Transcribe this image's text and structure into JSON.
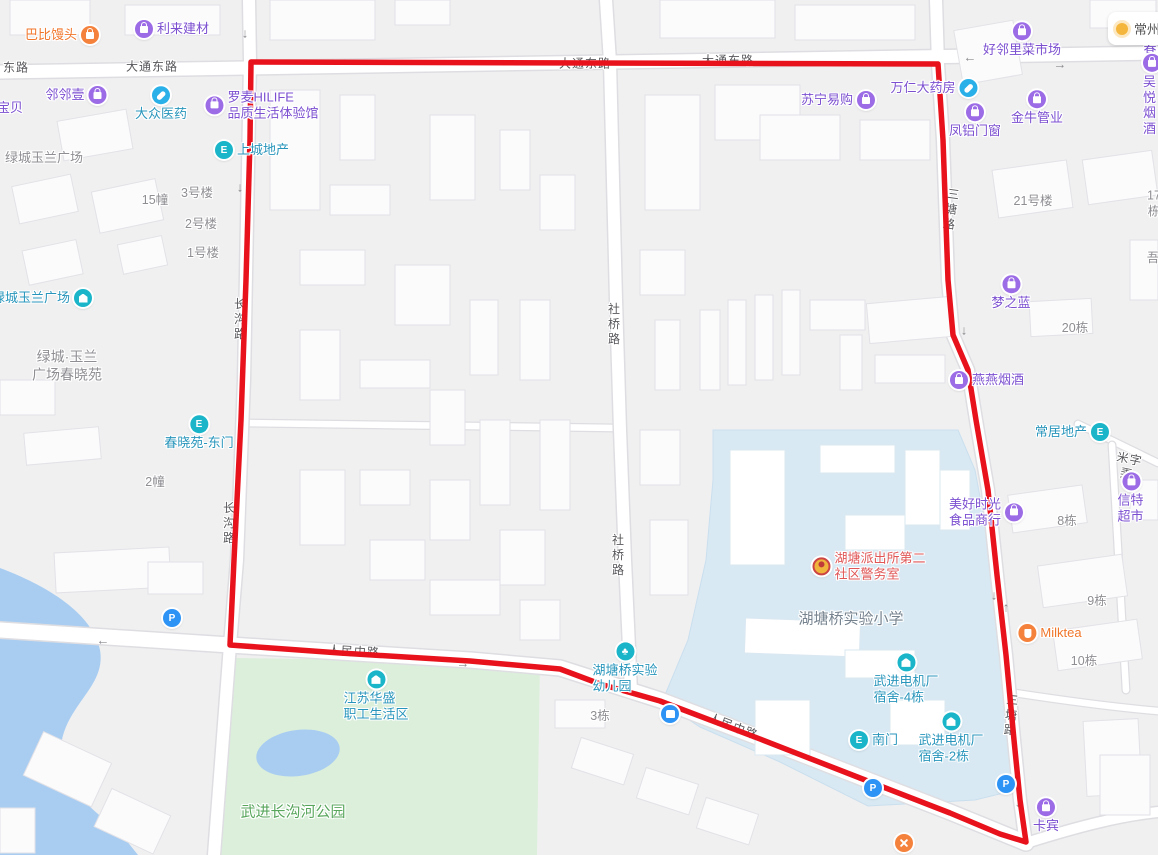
{
  "weather": {
    "city": "常州"
  },
  "route": {
    "color": "#e8121c",
    "points": [
      [
        251,
        62
      ],
      [
        938,
        64
      ],
      [
        943,
        140
      ],
      [
        948,
        280
      ],
      [
        953,
        335
      ],
      [
        968,
        370
      ],
      [
        976,
        420
      ],
      [
        988,
        490
      ],
      [
        997,
        575
      ],
      [
        1006,
        655
      ],
      [
        1014,
        740
      ],
      [
        1020,
        800
      ],
      [
        1026,
        842
      ],
      [
        1000,
        834
      ],
      [
        950,
        813
      ],
      [
        860,
        778
      ],
      [
        760,
        739
      ],
      [
        660,
        701
      ],
      [
        600,
        684
      ],
      [
        560,
        669
      ],
      [
        470,
        661
      ],
      [
        340,
        653
      ],
      [
        230,
        645
      ],
      [
        234,
        560
      ],
      [
        241,
        420
      ],
      [
        246,
        280
      ],
      [
        250,
        140
      ],
      [
        251,
        62
      ]
    ]
  },
  "road_labels": [
    {
      "name": "road-label-donglu",
      "text": "东路",
      "x": 16,
      "y": 68
    },
    {
      "name": "road-label-datongdonglu-1",
      "text": "大通东路",
      "x": 152,
      "y": 67
    },
    {
      "name": "road-label-datongdonglu-2",
      "text": "大通东路",
      "x": 585,
      "y": 64
    },
    {
      "name": "road-label-datongdonglu-3",
      "text": "大通东路",
      "x": 728,
      "y": 61
    },
    {
      "name": "road-label-changgoulu-1",
      "text": "长沟路",
      "x": 239,
      "y": 320,
      "vertical": true
    },
    {
      "name": "road-label-changgoulu-2",
      "text": "长沟路",
      "x": 228,
      "y": 524,
      "vertical": true
    },
    {
      "name": "road-label-sheqiaolu-1",
      "text": "社桥路",
      "x": 613,
      "y": 325,
      "vertical": true
    },
    {
      "name": "road-label-sheqiaolu-2",
      "text": "社桥路",
      "x": 617,
      "y": 556,
      "vertical": true
    },
    {
      "name": "road-label-santanglu-1",
      "text": "三塘路",
      "x": 950,
      "y": 210,
      "vertical": true,
      "rotate": 8
    },
    {
      "name": "road-label-santanglu-2",
      "text": "三塘路",
      "x": 1010,
      "y": 716,
      "vertical": true,
      "rotate": 5
    },
    {
      "name": "road-label-renminzhonglu-1",
      "text": "人民中路",
      "x": 354,
      "y": 652,
      "rotate": 3
    },
    {
      "name": "road-label-renminzhonglu-2",
      "text": "人民中路",
      "x": 733,
      "y": 727,
      "rotate": 21
    },
    {
      "name": "road-label-mizilong",
      "text": "米字弄",
      "x": 1128,
      "y": 467,
      "rotate": 11
    }
  ],
  "area_labels": [
    {
      "name": "area-label-lvcheng-yulan-plaza",
      "text": "绿城玉兰广场",
      "x": 44,
      "y": 158,
      "color": "gray",
      "size": 13
    },
    {
      "name": "area-label-lvcheng-chunxiaoyuan",
      "text": "绿城·玉兰\n广场春晓苑",
      "x": 67,
      "y": 366,
      "color": "gray",
      "size": 14
    },
    {
      "name": "area-label-hutangqiao-primary-school",
      "text": "湖塘桥实验小学",
      "x": 851,
      "y": 620,
      "color": "school",
      "size": 15
    },
    {
      "name": "area-label-wujin-changgouhe-park",
      "text": "武进长沟河公园",
      "x": 293,
      "y": 813,
      "color": "green",
      "size": 15
    }
  ],
  "building_labels": [
    {
      "name": "bldg-label-15zhuang",
      "text": "15幢",
      "x": 155,
      "y": 201
    },
    {
      "name": "bldg-label-3haolou",
      "text": "3号楼",
      "x": 197,
      "y": 194
    },
    {
      "name": "bldg-label-2haolou",
      "text": "2号楼",
      "x": 201,
      "y": 225
    },
    {
      "name": "bldg-label-1haolou",
      "text": "1号楼",
      "x": 203,
      "y": 254
    },
    {
      "name": "bldg-label-2zhuang",
      "text": "2幢",
      "x": 155,
      "y": 483
    },
    {
      "name": "bldg-label-3dong",
      "text": "3栋",
      "x": 600,
      "y": 717
    },
    {
      "name": "bldg-label-21haolou",
      "text": "21号楼",
      "x": 1033,
      "y": 202
    },
    {
      "name": "bldg-label-17dong",
      "text": "17栋",
      "x": 1154,
      "y": 204
    },
    {
      "name": "bldg-label-wu",
      "text": "吾",
      "x": 1153,
      "y": 259
    },
    {
      "name": "bldg-label-20dong",
      "text": "20栋",
      "x": 1075,
      "y": 329
    },
    {
      "name": "bldg-label-8dong",
      "text": "8栋",
      "x": 1067,
      "y": 522
    },
    {
      "name": "bldg-label-9dong",
      "text": "9栋",
      "x": 1097,
      "y": 602
    },
    {
      "name": "bldg-label-10dong",
      "text": "10栋",
      "x": 1084,
      "y": 662
    }
  ],
  "pois": [
    {
      "name": "poi-babi-mantou",
      "label": "巴比馒头",
      "x": 62,
      "y": 35,
      "icon": "orange-bag",
      "side": "right",
      "color": "orange"
    },
    {
      "name": "poi-lilai-jiancai",
      "label": "利来建材",
      "x": 172,
      "y": 29,
      "icon": "purple-bag",
      "side": "left",
      "color": "purple"
    },
    {
      "name": "poi-linlinyi",
      "label": "邻邻壹",
      "x": 76,
      "y": 95,
      "icon": "purple-bag",
      "side": "right",
      "color": "purple"
    },
    {
      "name": "poi-baobei",
      "label": "宝贝",
      "x": 10,
      "y": 108,
      "icon": "none",
      "side": "left",
      "color": "purple"
    },
    {
      "name": "poi-dazhong-yiyao",
      "label": "大众医药",
      "x": 161,
      "y": 104,
      "icon": "capsule",
      "side": "above",
      "color": "teal"
    },
    {
      "name": "poi-luomai-hilife",
      "label": "罗麦HILIFE\n品质生活体验馆",
      "x": 262,
      "y": 105,
      "icon": "purple-bag",
      "side": "left",
      "color": "purple"
    },
    {
      "name": "poi-shangcheng-dichan",
      "label": "上城地产",
      "x": 252,
      "y": 150,
      "icon": "teal-gate",
      "side": "left",
      "color": "teal"
    },
    {
      "name": "poi-suning-yigou",
      "label": "苏宁易购",
      "x": 838,
      "y": 100,
      "icon": "purple-bag",
      "side": "right",
      "color": "purple"
    },
    {
      "name": "poi-wanren-dayaofang",
      "label": "万仁大药房",
      "x": 934,
      "y": 88,
      "icon": "capsule",
      "side": "right",
      "color": "purple"
    },
    {
      "name": "poi-fenglv-menchuang",
      "label": "凤铝门窗",
      "x": 975,
      "y": 121,
      "icon": "purple-bag",
      "side": "above",
      "color": "purple"
    },
    {
      "name": "poi-haolinli-caishichang",
      "label": "好邻里菜市场",
      "x": 1022,
      "y": 40,
      "icon": "purple-bag",
      "side": "above",
      "color": "purple"
    },
    {
      "name": "poi-tingchun",
      "label": "听春南",
      "x": 1150,
      "y": 48,
      "icon": "none",
      "side": "left",
      "color": "purple"
    },
    {
      "name": "poi-jinniu-guanye",
      "label": "金牛管业",
      "x": 1037,
      "y": 108,
      "icon": "purple-bag",
      "side": "above",
      "color": "purple"
    },
    {
      "name": "poi-wuyue-yanjiu",
      "label": "吴悦烟酒",
      "x": 1152,
      "y": 95,
      "icon": "purple-bag",
      "side": "above",
      "color": "purple"
    },
    {
      "name": "poi-lvcheng-yulan-plaza",
      "label": "绿城玉兰广场",
      "x": 42,
      "y": 298,
      "icon": "teal-house",
      "side": "right",
      "color": "teal"
    },
    {
      "name": "poi-chunxiaoyuan-dongmen",
      "label": "春晓苑-东门",
      "x": 199,
      "y": 433,
      "icon": "teal-gate",
      "side": "above",
      "color": "teal"
    },
    {
      "name": "poi-mengzhilan",
      "label": "梦之蓝",
      "x": 1011,
      "y": 293,
      "icon": "purple-bag",
      "side": "above",
      "color": "purple"
    },
    {
      "name": "poi-yanyan-yanjiu",
      "label": "燕燕烟酒",
      "x": 987,
      "y": 380,
      "icon": "purple-bag",
      "side": "left",
      "color": "purple"
    },
    {
      "name": "poi-changju-dichan",
      "label": "常居地产",
      "x": 1072,
      "y": 432,
      "icon": "teal-gate",
      "side": "right",
      "color": "teal"
    },
    {
      "name": "poi-meihao-shiguang",
      "label": "美好时光\n食品商行",
      "x": 986,
      "y": 512,
      "icon": "purple-bag",
      "side": "right",
      "color": "purple"
    },
    {
      "name": "poi-xinte-chaoshi",
      "label": "信特超市",
      "x": 1131,
      "y": 498,
      "icon": "purple-bag",
      "side": "above",
      "color": "purple"
    },
    {
      "name": "poi-milktea",
      "label": "Milktea",
      "x": 1050,
      "y": 633,
      "icon": "orange-cup",
      "side": "left",
      "color": "orange"
    },
    {
      "name": "poi-hutang-paichusuo",
      "label": "湖塘派出所第二\n社区警务室",
      "x": 869,
      "y": 566,
      "icon": "police",
      "side": "left",
      "color": "red"
    },
    {
      "name": "poi-hutangqiao-kindergarten",
      "label": "湖塘桥实验\n幼儿园",
      "x": 625,
      "y": 668,
      "icon": "tree",
      "side": "above",
      "color": "teal"
    },
    {
      "name": "poi-bus-stop",
      "label": "",
      "x": 670,
      "y": 714,
      "icon": "bus",
      "side": "only",
      "color": "teal"
    },
    {
      "name": "poi-jiangsu-huasheng",
      "label": "江苏华盛\n职工生活区",
      "x": 376,
      "y": 696,
      "icon": "teal-house",
      "side": "above",
      "color": "teal"
    },
    {
      "name": "poi-wujin-dianjichang-sushe-4",
      "label": "武进电机厂\n宿舍-4栋",
      "x": 906,
      "y": 679,
      "icon": "teal-house",
      "side": "above",
      "color": "teal"
    },
    {
      "name": "poi-nanmen",
      "label": "南门",
      "x": 874,
      "y": 740,
      "icon": "teal-gate",
      "side": "left",
      "color": "teal"
    },
    {
      "name": "poi-wujin-dianjichang-sushe-2",
      "label": "武进电机厂\n宿舍-2栋",
      "x": 951,
      "y": 738,
      "icon": "teal-house",
      "side": "above",
      "color": "teal"
    },
    {
      "name": "poi-parking-west",
      "label": "",
      "x": 172,
      "y": 618,
      "icon": "parking",
      "side": "only",
      "color": "teal"
    },
    {
      "name": "poi-parking-south",
      "label": "",
      "x": 873,
      "y": 788,
      "icon": "parking",
      "side": "only",
      "color": "teal"
    },
    {
      "name": "poi-parking-east",
      "label": "",
      "x": 1006,
      "y": 784,
      "icon": "parking",
      "side": "only",
      "color": "teal"
    },
    {
      "name": "poi-kabin",
      "label": "卡宾",
      "x": 1046,
      "y": 816,
      "icon": "purple-bag",
      "side": "above",
      "color": "purple"
    },
    {
      "name": "poi-restaurant",
      "label": "",
      "x": 904,
      "y": 843,
      "icon": "orange-rest",
      "side": "only",
      "color": "orange"
    }
  ],
  "arrows": [
    {
      "name": "arrow-down-1",
      "glyph": "↓",
      "x": 245,
      "y": 33
    },
    {
      "name": "arrow-down-2",
      "glyph": "↓",
      "x": 240,
      "y": 187
    },
    {
      "name": "arrow-left-1",
      "glyph": "←",
      "x": 970,
      "y": 57
    },
    {
      "name": "arrow-right-1",
      "glyph": "→",
      "x": 1060,
      "y": 64
    },
    {
      "name": "arrow-down-3",
      "glyph": "↓",
      "x": 944,
      "y": 182
    },
    {
      "name": "arrow-down-4",
      "glyph": "↓",
      "x": 964,
      "y": 330
    },
    {
      "name": "arrow-down-5",
      "glyph": "↓",
      "x": 994,
      "y": 595
    },
    {
      "name": "arrow-up-1",
      "glyph": "↑",
      "x": 1006,
      "y": 607
    },
    {
      "name": "arrow-left-2",
      "glyph": "←",
      "x": 103,
      "y": 640
    },
    {
      "name": "arrow-right-2",
      "glyph": "→",
      "x": 463,
      "y": 663
    },
    {
      "name": "arrow-down-6",
      "glyph": "↓",
      "x": 1018,
      "y": 802
    }
  ]
}
